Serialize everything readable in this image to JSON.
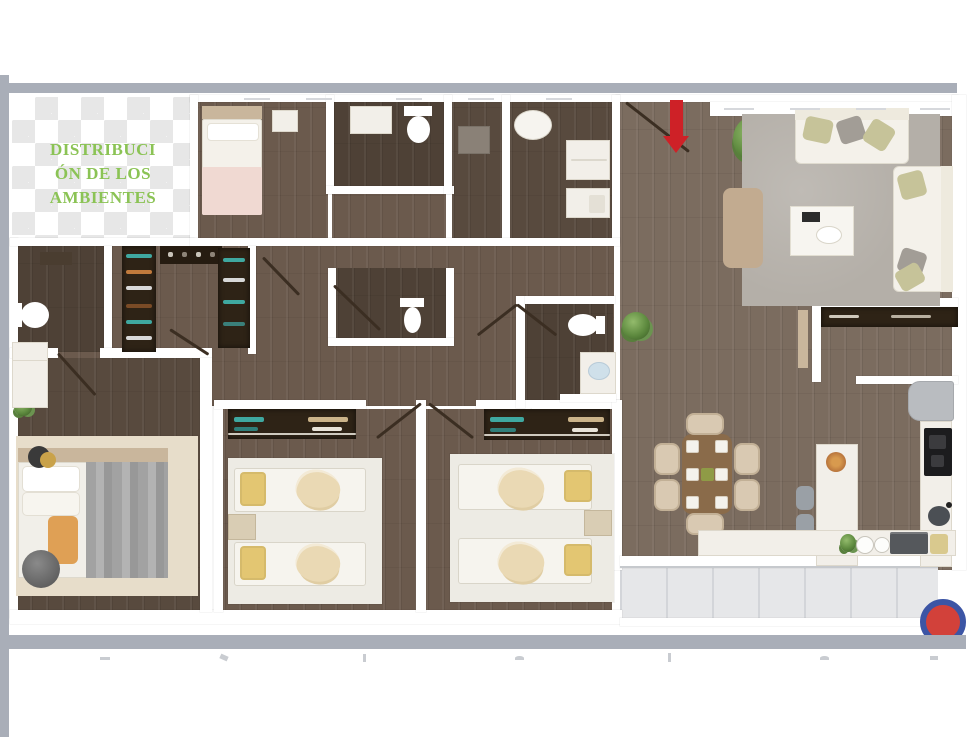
{
  "title": {
    "text": "DISTRIBUCIÓN DE LOS AMBIENTES",
    "lines": [
      "DISTRIBUCI",
      "ÓN DE LOS",
      "AMBIENTES"
    ]
  },
  "floor_plan": {
    "description": "3D top-down rendered apartment floor plan on transparent checkerboard corner",
    "entrance_marker": "red-arrow-down",
    "logo_badge": "red-circle-with-blue-ring",
    "rooms": [
      "single-bedroom",
      "bathroom",
      "shower-room",
      "laundry",
      "entry-hall",
      "living-room",
      "walk-in-closet",
      "guest-bathroom",
      "master-bedroom",
      "twin-bedroom-1",
      "twin-bedroom-2",
      "dining-area",
      "kitchen",
      "balcony"
    ]
  },
  "colors": {
    "bar": "#a9aeb8",
    "checker": "#e7e7e7",
    "title_green": "#8bc355",
    "wall": "#ffffff",
    "wood_light": "#7b6c5f",
    "wood_mid": "#6b5a4d",
    "wood_dark": "#584a3e",
    "wood_darkest": "#4e4136",
    "rug_gray": "#b4afa8",
    "rug_beige": "#e7ddca",
    "mat": "#edebe4",
    "sofa": "#f4f1ea",
    "pillow_olive": "#c6c399",
    "pillow_gray": "#a29d96",
    "pillow_yellow": "#e3c672",
    "pillow_orange": "#dfa055",
    "blanket_pink": "#f0d9d2",
    "tan_wood": "#c9b69c",
    "bench": "#c2ab90",
    "closet": "#2e2316",
    "teal": "#3fa8a0",
    "clothes_orange": "#c07a3c",
    "counter": "#f2efe9",
    "table_wood": "#8a6b4a",
    "chair": "#d9c9b2",
    "cooktop": "#1c1c1e",
    "fridge": "#b9bcc0",
    "steel": "#55585c",
    "tile": "#e6e7e9",
    "tile_line": "#d3d5d9",
    "arrow": "#ce2127",
    "logo_red": "#d2413a",
    "logo_blue": "#3c55a5",
    "door": "#3b2e22",
    "faint": "#d6d8dc"
  }
}
